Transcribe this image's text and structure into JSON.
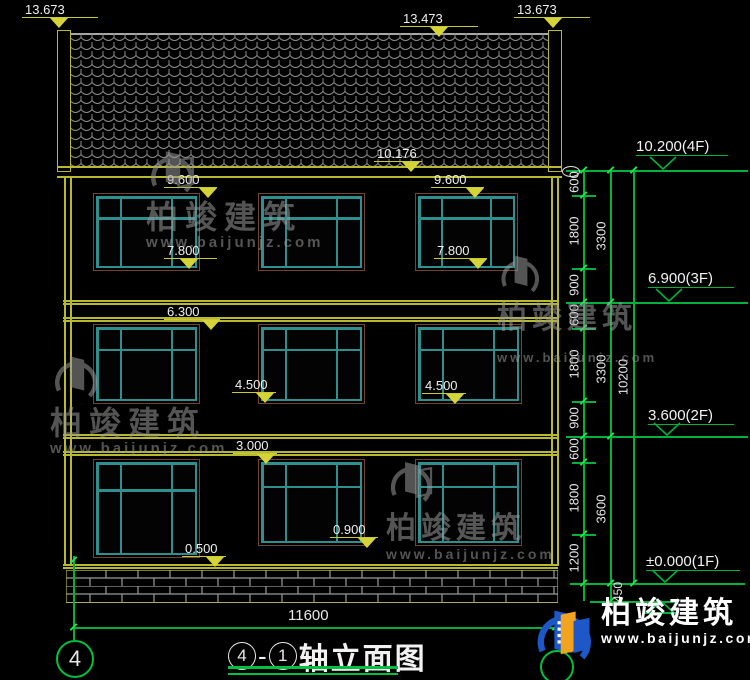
{
  "drawing": {
    "facade_markers": {
      "roof_left": "13.673",
      "ridge": "13.473",
      "roof_right": "13.673",
      "eave": "10.176",
      "f3_head_a": "9.600",
      "f3_head_b": "9.600",
      "f3_sill_a": "7.800",
      "f3_sill_b": "7.800",
      "f2_head": "6.300",
      "f2_sill_a": "4.500",
      "f2_sill_b": "4.500",
      "f1_head": "3.000",
      "f1_sill_a": "0.500",
      "f1_sill_b": "0.900"
    },
    "levels": {
      "f4": "10.200(4F)",
      "f3": "6.900(3F)",
      "f2": "3.600(2F)",
      "f1": "±0.000(1F)"
    },
    "right_dims": {
      "chain_a": [
        "600",
        "1800",
        "900",
        "600",
        "1800",
        "900",
        "600",
        "1800",
        "1200"
      ],
      "chain_b": [
        "3300",
        "3300",
        "3600"
      ],
      "total": "10200",
      "below_datum": "450"
    },
    "width_dim": "11600",
    "axis_bubble_left": "4",
    "title": {
      "circle_a": "4",
      "dash": "-",
      "circle_b": "1",
      "text": "轴立面图"
    }
  },
  "watermark": {
    "brand": "柏竣建筑",
    "url": "www.baijunjz.com"
  },
  "footer_logo": {
    "brand": "柏竣建筑",
    "url": "www.baijunjz.com"
  },
  "colors": {
    "line_yellow": "#b9b92f",
    "line_green": "#00b23b",
    "tick_green": "#24e04a",
    "window_teal": "#2e8f8f",
    "window_frame_brown": "#6f4630",
    "text_white": "#ececec",
    "watermark_gray": "#9a9a9a",
    "logo_blue": "#1d57c8",
    "logo_orange": "#f2a31f",
    "tile_gray": "#8c8c8c",
    "brick_gray": "#9b9b9b"
  }
}
